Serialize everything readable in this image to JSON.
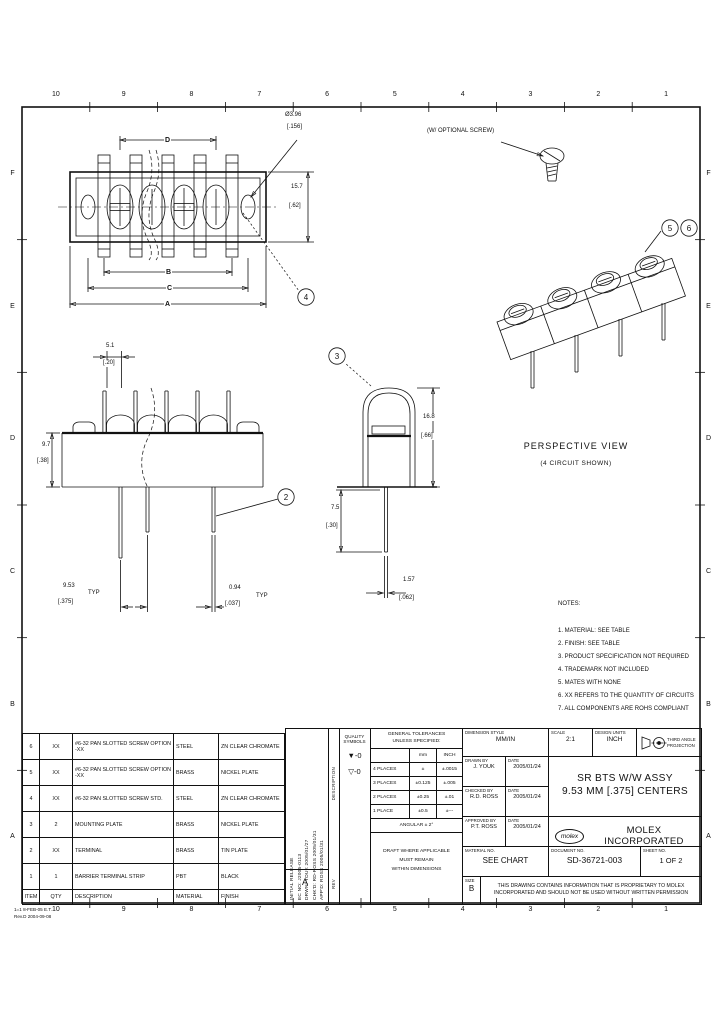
{
  "frame": {
    "zones_top": [
      "10",
      "9",
      "8",
      "7",
      "6",
      "5",
      "4",
      "3",
      "2",
      "1"
    ],
    "zones_bottom": [
      "10",
      "9",
      "8",
      "7",
      "6",
      "5",
      "4",
      "3",
      "2",
      "1"
    ],
    "rows_left": [
      "F",
      "E",
      "D",
      "C",
      "B",
      "A"
    ],
    "rows_right": [
      "F",
      "E",
      "D",
      "C",
      "B",
      "A"
    ],
    "stamp_line1": "1=1 8-FEB-05 E.T.",
    "stamp_line2": "Rev.D 2004-09-08"
  },
  "top_view": {
    "dim_d": "D",
    "dim_b": "B",
    "dim_c": "C",
    "dim_a": "A",
    "screw_dia_mm": "Ø3.96",
    "screw_dia_in": "[.156]",
    "height_mm": "15.7",
    "height_in": "[.62]",
    "balloon": "4"
  },
  "perspective": {
    "callout": "(W/ OPTIONAL SCREW)",
    "balloon_a": "5",
    "balloon_b": "6",
    "label": "PERSPECTIVE VIEW",
    "sublabel": "(4 CIRCUIT SHOWN)"
  },
  "front_view": {
    "slot_mm": "5.1",
    "slot_in": "[.20]",
    "height_mm": "9.7",
    "height_in": "[.38]",
    "pitch_mm": "9.53",
    "pitch_in": "[.375]",
    "pitch_typ": "TYP",
    "tab_mm": "0.94",
    "tab_in": "[.037]",
    "tab_typ": "TYP",
    "balloon": "2"
  },
  "side_view": {
    "height_mm": "16.8",
    "height_in": "[.66]",
    "pin_mm": "7.5",
    "pin_in": "[.30]",
    "width_mm": "1.57",
    "width_in": "[.062]",
    "balloon": "3"
  },
  "notes": {
    "heading": "NOTES:",
    "items": [
      "1. MATERIAL: SEE TABLE",
      "2. FINISH: SEE TABLE",
      "3. PRODUCT SPECIFICATION NOT REQUIRED",
      "4. TRADEMARK NOT INCLUDED",
      "5. MATES WITH NONE",
      "6. XX REFERS TO THE QUANTITY OF CIRCUITS",
      "7. ALL COMPONENTS ARE ROHS COMPLIANT"
    ]
  },
  "parts_table": {
    "rows": [
      {
        "item": "6",
        "qty": "XX",
        "desc": "#6-32 PAN SLOTTED SCREW OPTION -XX",
        "mat": "STEEL",
        "fin": "ZN CLEAR CHROMATE"
      },
      {
        "item": "5",
        "qty": "XX",
        "desc": "#6-32 PAN SLOTTED SCREW OPTION -XX",
        "mat": "BRASS",
        "fin": "NICKEL PLATE"
      },
      {
        "item": "4",
        "qty": "XX",
        "desc": "#6-32 PAN SLOTTED SCREW STD.",
        "mat": "STEEL",
        "fin": "ZN CLEAR CHROMATE"
      },
      {
        "item": "3",
        "qty": "2",
        "desc": "MOUNTING PLATE",
        "mat": "BRASS",
        "fin": "NICKEL PLATE"
      },
      {
        "item": "2",
        "qty": "XX",
        "desc": "TERMINAL",
        "mat": "BRASS",
        "fin": "TIN PLATE"
      },
      {
        "item": "1",
        "qty": "1",
        "desc": "BARRIER TERMINAL STRIP",
        "mat": "PBT",
        "fin": "BLACK"
      }
    ],
    "headers": {
      "item": "ITEM",
      "qty": "QTY",
      "desc": "DESCRIPTION",
      "mat": "MATERIAL",
      "fin": "FINISH"
    }
  },
  "revision": {
    "lines": [
      "INITIAL RELEASE",
      "EC NO: J2005-0113",
      "DRWN: YOUK 2005/01/27",
      "CHK'D: RD-ROSS 2005/01/31",
      "APP'D: ROSS 2005/01/31"
    ],
    "rev_letter": "A",
    "col_description": "DESCRIPTION",
    "col_rev": "REV"
  },
  "quality": {
    "title_line1": "QUALITY",
    "title_line2": "SYMBOLS",
    "symbols": [
      "▼-0",
      "▽-0"
    ]
  },
  "tolerances": {
    "title_line1": "GENERAL TOLERANCES",
    "title_line2": "UNLESS SPECIFIED:",
    "col_mm": "mm",
    "col_inch": "INCH",
    "rows": [
      {
        "label": "4 PLACES",
        "mm": "±",
        "inch": "±.0015"
      },
      {
        "label": "3 PLACES",
        "mm": "±0.125",
        "inch": "±.005"
      },
      {
        "label": "2 PLACES",
        "mm": "±0.25",
        "inch": "±.01"
      },
      {
        "label": "1 PLACE",
        "mm": "±0.5",
        "inch": "±---"
      }
    ],
    "angular": "ANGULAR ± 2°",
    "draft_line1": "DRAFT WHERE APPLICABLE",
    "draft_line2": "MUST REMAIN",
    "draft_line3": "WITHIN DIMENSIONS"
  },
  "title_block": {
    "dim_style_label": "DIMENSION STYLE",
    "dim_style": "MM/IN",
    "scale_label": "SCALE",
    "scale": "2:1",
    "design_units_label": "DESIGN UNITS",
    "design_units": "INCH",
    "projection_line1": "THIRD ANGLE",
    "projection_line2": "PROJECTION",
    "drawn_by_label": "DRAWN BY",
    "drawn_date_label": "DATE",
    "drawn_by": "J. YOUK",
    "drawn_date": "2005/01/24",
    "checked_by_label": "CHECKED BY",
    "checked_date_label": "DATE",
    "checked_by": "R.D. ROSS",
    "checked_date": "2005/01/24",
    "approved_by_label": "APPROVED BY",
    "approved_date_label": "DATE",
    "approved_by": "P.T. ROSS",
    "approved_date": "2005/01/24",
    "title_line1": "SR BTS W/W ASSY",
    "title_line2": "9.53 MM [.375] CENTERS",
    "logo_text": "molex",
    "company": "MOLEX INCORPORATED",
    "material_label": "MATERIAL NO.",
    "material": "SEE CHART",
    "document_label": "DOCUMENT NO.",
    "document": "SD-36721-003",
    "sheet_label": "SHEET NO.",
    "sheet": "1 OF 2",
    "size_label": "SIZE",
    "size": "B",
    "disclaimer_line1": "THIS DRAWING CONTAINS INFORMATION THAT IS PROPRIETARY TO MOLEX",
    "disclaimer_line2": "INCORPORATED AND SHOULD NOT BE USED WITHOUT WRITTEN PERMISSION"
  }
}
